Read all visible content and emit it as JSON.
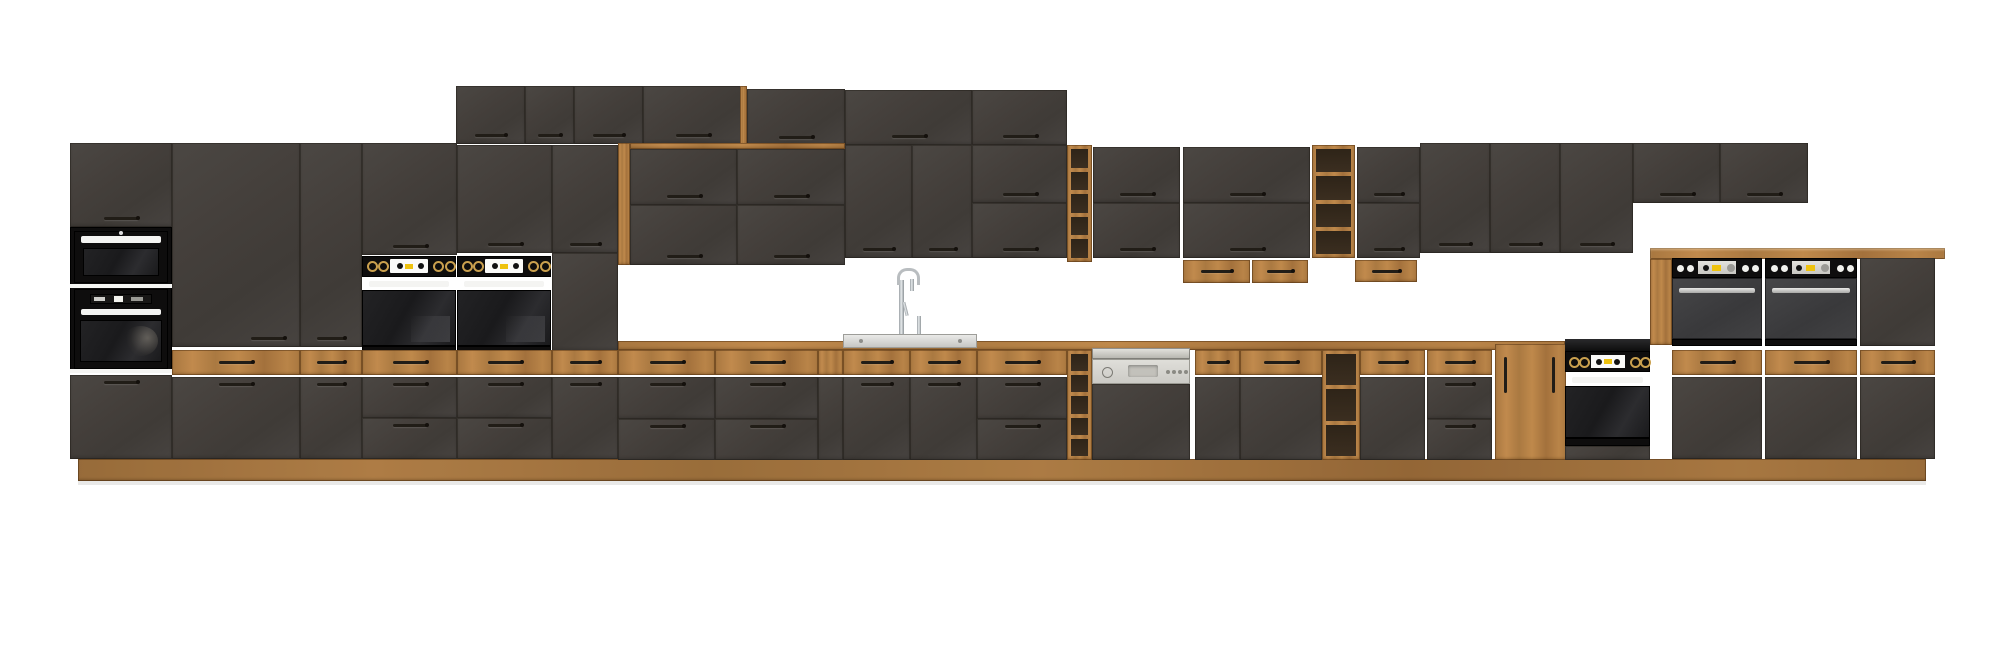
{
  "scene": {
    "description": "kitchen cabinet set product render - dark concrete-look fronts with oak wood accents and built-in appliances on white background",
    "stage": {
      "width": 2000,
      "height": 662
    },
    "colors": {
      "background": "#ffffff",
      "front_dark": "#45413d",
      "oak": "#b27e45",
      "oak_interior": "#3b2e20",
      "appliance_black": "#0e0d0d",
      "gloss_black": "#1d1d1f",
      "oven_grey": "#3f3f41",
      "steel": "#c9c9c5",
      "panel_grey": "#d8d6d0",
      "handle_dark": "#211d17",
      "handle_white": "#f4f4f2",
      "display_yellow": "#eec20e",
      "display_white": "#fafaf8",
      "knob_gold": "#caa04e",
      "chrome": "#c2c6c9",
      "white_sep": "#f5f5f3"
    },
    "modules": [
      {
        "name": "toe-kick-shadow",
        "type": "shadow",
        "x": 78,
        "y": 481,
        "w": 1848,
        "h": 4
      },
      {
        "name": "oak-plinth",
        "type": "plinth",
        "x": 78,
        "y": 459,
        "w": 1848,
        "h": 22
      },
      {
        "name": "tall-oven-tower-top-door",
        "type": "door",
        "x": 70,
        "y": 143,
        "w": 102,
        "h": 84,
        "handle": "bc"
      },
      {
        "name": "tall-oven-tower-appliance-panel",
        "type": "panelblack",
        "x": 70,
        "y": 227,
        "w": 102,
        "h": 146
      },
      {
        "name": "built-in-microwave",
        "type": "microwave",
        "x": 74,
        "y": 231,
        "w": 94,
        "h": 52
      },
      {
        "name": "microwave-oven-separator",
        "type": "whitesep",
        "x": 70,
        "y": 284,
        "w": 102,
        "h": 4
      },
      {
        "name": "built-in-oven-tower",
        "type": "toweroven",
        "x": 74,
        "y": 289,
        "w": 94,
        "h": 80
      },
      {
        "name": "oven-bottom-separator",
        "type": "whitesep",
        "x": 70,
        "y": 369,
        "w": 102,
        "h": 4
      },
      {
        "name": "tall-oven-tower-bottom-door",
        "type": "door",
        "x": 70,
        "y": 375,
        "w": 102,
        "h": 84,
        "handle": "tc"
      },
      {
        "name": "tall-pantry-door",
        "type": "door",
        "x": 172,
        "y": 143,
        "w": 128,
        "h": 204,
        "handle": "br"
      },
      {
        "name": "tall-pantry-door-narrow",
        "type": "door",
        "x": 300,
        "y": 143,
        "w": 62,
        "h": 204,
        "handle": "bc"
      },
      {
        "name": "wall-door-above-oven-1",
        "type": "door",
        "x": 362,
        "y": 143,
        "w": 95,
        "h": 112,
        "handle": "bc"
      },
      {
        "name": "wall-door-above-oven-2",
        "type": "door",
        "x": 457,
        "y": 145,
        "w": 95,
        "h": 108,
        "handle": "bc"
      },
      {
        "name": "wall-door-tall-run-end",
        "type": "door",
        "x": 552,
        "y": 145,
        "w": 66,
        "h": 108,
        "handle": "bc"
      },
      {
        "name": "tall-run-side-panel",
        "type": "paneldark",
        "x": 552,
        "y": 253,
        "w": 66,
        "h": 98
      },
      {
        "name": "built-in-oven-left-1",
        "type": "ovenblack",
        "x": 362,
        "y": 256,
        "w": 94,
        "h": 97
      },
      {
        "name": "built-in-oven-left-2",
        "type": "ovenblack",
        "x": 457,
        "y": 256,
        "w": 94,
        "h": 97
      },
      {
        "name": "top-wall-door-1",
        "type": "door",
        "x": 456,
        "y": 86,
        "w": 69,
        "h": 58,
        "handle": "bc"
      },
      {
        "name": "top-wall-door-2",
        "type": "door",
        "x": 525,
        "y": 86,
        "w": 49,
        "h": 58,
        "handle": "bc"
      },
      {
        "name": "top-wall-door-3",
        "type": "door",
        "x": 574,
        "y": 86,
        "w": 69,
        "h": 58,
        "handle": "bc"
      },
      {
        "name": "top-wall-door-4",
        "type": "door",
        "x": 643,
        "y": 86,
        "w": 99,
        "h": 58,
        "handle": "bc"
      },
      {
        "name": "top-row-oak-step-edge",
        "type": "oakstrip",
        "x": 740,
        "y": 86,
        "w": 7,
        "h": 60
      },
      {
        "name": "top-wall-door-5",
        "type": "door",
        "x": 747,
        "y": 89,
        "w": 98,
        "h": 57,
        "handle": "bc"
      },
      {
        "name": "top-wall-door-6",
        "type": "door",
        "x": 845,
        "y": 90,
        "w": 127,
        "h": 55,
        "handle": "bc"
      },
      {
        "name": "top-wall-door-7",
        "type": "door",
        "x": 972,
        "y": 90,
        "w": 95,
        "h": 55,
        "handle": "bc"
      },
      {
        "name": "recess-oak-lining-left",
        "type": "oakstrip",
        "x": 618,
        "y": 143,
        "w": 12,
        "h": 122
      },
      {
        "name": "recess-oak-lining-top",
        "type": "oakstrip",
        "x": 630,
        "y": 143,
        "w": 215,
        "h": 6
      },
      {
        "name": "recess-wall-door-1",
        "type": "door",
        "x": 630,
        "y": 149,
        "w": 107,
        "h": 56,
        "handle": "bc"
      },
      {
        "name": "recess-wall-door-2",
        "type": "door",
        "x": 737,
        "y": 149,
        "w": 108,
        "h": 56,
        "handle": "bc"
      },
      {
        "name": "recess-wall-door-3",
        "type": "door",
        "x": 630,
        "y": 205,
        "w": 107,
        "h": 60,
        "handle": "bc"
      },
      {
        "name": "recess-wall-door-4",
        "type": "door",
        "x": 737,
        "y": 205,
        "w": 108,
        "h": 60,
        "handle": "bc"
      },
      {
        "name": "wall-door-8",
        "type": "door",
        "x": 845,
        "y": 145,
        "w": 67,
        "h": 113,
        "handle": "bc"
      },
      {
        "name": "wall-door-9",
        "type": "door",
        "x": 912,
        "y": 145,
        "w": 60,
        "h": 113,
        "handle": "bc"
      },
      {
        "name": "wall-door-10",
        "type": "door",
        "x": 972,
        "y": 145,
        "w": 95,
        "h": 58,
        "handle": "bc"
      },
      {
        "name": "wall-door-11",
        "type": "door",
        "x": 972,
        "y": 203,
        "w": 95,
        "h": 55,
        "handle": "bc"
      },
      {
        "name": "wall-open-shelf-1",
        "type": "shelf",
        "x": 1067,
        "y": 145,
        "w": 25,
        "h": 117,
        "comps": 5
      },
      {
        "name": "wall-door-12",
        "type": "door",
        "x": 1093,
        "y": 147,
        "w": 87,
        "h": 56,
        "handle": "bc"
      },
      {
        "name": "wall-door-13",
        "type": "door",
        "x": 1093,
        "y": 203,
        "w": 87,
        "h": 55,
        "handle": "bc"
      },
      {
        "name": "wall-door-14",
        "type": "door",
        "x": 1183,
        "y": 147,
        "w": 127,
        "h": 56,
        "handle": "bc"
      },
      {
        "name": "wall-door-15",
        "type": "door",
        "x": 1183,
        "y": 203,
        "w": 127,
        "h": 55,
        "handle": "bc"
      },
      {
        "name": "hanging-oak-box-1",
        "type": "oakbox",
        "x": 1183,
        "y": 260,
        "w": 67,
        "h": 23
      },
      {
        "name": "hanging-oak-box-2",
        "type": "oakbox",
        "x": 1252,
        "y": 260,
        "w": 56,
        "h": 23
      },
      {
        "name": "wall-open-shelf-2",
        "type": "shelf",
        "x": 1312,
        "y": 145,
        "w": 43,
        "h": 113,
        "comps": 4
      },
      {
        "name": "wall-door-16",
        "type": "door",
        "x": 1357,
        "y": 147,
        "w": 63,
        "h": 56,
        "handle": "bc"
      },
      {
        "name": "wall-door-17",
        "type": "door",
        "x": 1357,
        "y": 203,
        "w": 63,
        "h": 55,
        "handle": "bc"
      },
      {
        "name": "hanging-oak-box-3",
        "type": "oakbox",
        "x": 1355,
        "y": 260,
        "w": 62,
        "h": 22
      },
      {
        "name": "wall-door-18",
        "type": "door",
        "x": 1420,
        "y": 143,
        "w": 70,
        "h": 110,
        "handle": "bc"
      },
      {
        "name": "wall-door-19",
        "type": "door",
        "x": 1490,
        "y": 143,
        "w": 70,
        "h": 110,
        "handle": "bc"
      },
      {
        "name": "wall-door-20",
        "type": "door",
        "x": 1560,
        "y": 143,
        "w": 73,
        "h": 110,
        "handle": "bc"
      },
      {
        "name": "wall-door-21",
        "type": "door",
        "x": 1633,
        "y": 143,
        "w": 87,
        "h": 60,
        "handle": "bc"
      },
      {
        "name": "wall-door-22",
        "type": "door",
        "x": 1720,
        "y": 143,
        "w": 88,
        "h": 60,
        "handle": "bc"
      },
      {
        "name": "counter-oak-edge",
        "type": "oakstrip",
        "x": 618,
        "y": 341,
        "w": 947,
        "h": 9
      },
      {
        "name": "oak-drawer-l1",
        "type": "oakdrawer",
        "x": 172,
        "y": 350,
        "w": 128,
        "h": 25
      },
      {
        "name": "oak-drawer-l2",
        "type": "oakdrawer",
        "x": 300,
        "y": 350,
        "w": 62,
        "h": 25
      },
      {
        "name": "oak-drawer-l3",
        "type": "oakdrawer",
        "x": 362,
        "y": 350,
        "w": 95,
        "h": 25
      },
      {
        "name": "oak-drawer-l4",
        "type": "oakdrawer",
        "x": 457,
        "y": 350,
        "w": 95,
        "h": 25
      },
      {
        "name": "oak-drawer-l5",
        "type": "oakdrawer",
        "x": 552,
        "y": 350,
        "w": 66,
        "h": 25
      },
      {
        "name": "oak-drawer-m1",
        "type": "oakdrawer",
        "x": 618,
        "y": 350,
        "w": 97,
        "h": 25
      },
      {
        "name": "oak-drawer-m2",
        "type": "oakdrawer",
        "x": 715,
        "y": 350,
        "w": 103,
        "h": 25
      },
      {
        "name": "oak-filler",
        "type": "oakdrawer",
        "x": 818,
        "y": 350,
        "w": 25,
        "h": 25,
        "nohandle": true
      },
      {
        "name": "oak-drawer-sink-1",
        "type": "oakdrawer",
        "x": 843,
        "y": 350,
        "w": 67,
        "h": 25
      },
      {
        "name": "oak-drawer-sink-2",
        "type": "oakdrawer",
        "x": 910,
        "y": 350,
        "w": 67,
        "h": 25
      },
      {
        "name": "oak-drawer-m3",
        "type": "oakdrawer",
        "x": 977,
        "y": 350,
        "w": 90,
        "h": 25
      },
      {
        "name": "base-open-shelf-1",
        "type": "shelf",
        "x": 1067,
        "y": 350,
        "w": 25,
        "h": 110,
        "comps": 5
      },
      {
        "name": "semi-integrated-dishwasher",
        "type": "dishwasher",
        "x": 1092,
        "y": 348,
        "w": 98,
        "h": 112
      },
      {
        "name": "oak-drawer-m4",
        "type": "oakdrawer",
        "x": 1195,
        "y": 350,
        "w": 45,
        "h": 25
      },
      {
        "name": "oak-drawer-m5",
        "type": "oakdrawer",
        "x": 1240,
        "y": 350,
        "w": 82,
        "h": 25
      },
      {
        "name": "base-open-shelf-2",
        "type": "shelf",
        "x": 1322,
        "y": 350,
        "w": 38,
        "h": 110,
        "comps": 3
      },
      {
        "name": "oak-drawer-m6",
        "type": "oakdrawer",
        "x": 1360,
        "y": 350,
        "w": 65,
        "h": 25
      },
      {
        "name": "oak-drawer-m7",
        "type": "oakdrawer",
        "x": 1427,
        "y": 350,
        "w": 65,
        "h": 25
      },
      {
        "name": "base-door-l1",
        "type": "door",
        "x": 172,
        "y": 377,
        "w": 128,
        "h": 82,
        "handle": "tc"
      },
      {
        "name": "base-door-l2",
        "type": "door",
        "x": 300,
        "y": 377,
        "w": 62,
        "h": 82,
        "handle": "tc"
      },
      {
        "name": "base-drawers-l1",
        "type": "drawers2",
        "x": 362,
        "y": 377,
        "w": 95,
        "h": 82
      },
      {
        "name": "base-drawers-l2",
        "type": "drawers2",
        "x": 457,
        "y": 377,
        "w": 95,
        "h": 82
      },
      {
        "name": "base-door-l3",
        "type": "door",
        "x": 552,
        "y": 377,
        "w": 66,
        "h": 82,
        "handle": "tc"
      },
      {
        "name": "base-drawers-m1",
        "type": "drawers2",
        "x": 618,
        "y": 377,
        "w": 97,
        "h": 83
      },
      {
        "name": "base-drawers-m2",
        "type": "drawers2",
        "x": 715,
        "y": 377,
        "w": 103,
        "h": 83
      },
      {
        "name": "base-filler-dark",
        "type": "paneldark",
        "x": 818,
        "y": 377,
        "w": 25,
        "h": 83
      },
      {
        "name": "sink-base-door-1",
        "type": "door",
        "x": 843,
        "y": 377,
        "w": 67,
        "h": 83,
        "handle": "tc"
      },
      {
        "name": "sink-base-door-2",
        "type": "door",
        "x": 910,
        "y": 377,
        "w": 67,
        "h": 83,
        "handle": "tc"
      },
      {
        "name": "base-drawers-m3",
        "type": "drawers2",
        "x": 977,
        "y": 377,
        "w": 90,
        "h": 83
      },
      {
        "name": "base-door-m4",
        "type": "door",
        "x": 1195,
        "y": 377,
        "w": 45,
        "h": 83
      },
      {
        "name": "base-door-m5",
        "type": "door",
        "x": 1240,
        "y": 377,
        "w": 82,
        "h": 83
      },
      {
        "name": "base-door-m6",
        "type": "door",
        "x": 1360,
        "y": 377,
        "w": 65,
        "h": 83
      },
      {
        "name": "base-drawers-m7",
        "type": "drawers2",
        "x": 1427,
        "y": 377,
        "w": 65,
        "h": 83
      },
      {
        "name": "oak-base-cabinet",
        "type": "oakcab",
        "x": 1495,
        "y": 344,
        "w": 71,
        "h": 116
      },
      {
        "name": "kitchen-sink",
        "type": "sink",
        "x": 843,
        "y": 334,
        "w": 134,
        "h": 14
      },
      {
        "name": "black-cooktop-strip",
        "type": "cooktop",
        "x": 1565,
        "y": 339,
        "w": 85,
        "h": 12
      },
      {
        "name": "built-in-single-oven",
        "type": "ovensingle",
        "x": 1565,
        "y": 351,
        "w": 85,
        "h": 109
      },
      {
        "name": "right-bank-oak-countertop",
        "type": "counter",
        "x": 1650,
        "y": 248,
        "w": 295,
        "h": 11
      },
      {
        "name": "right-bank-oak-side-panel",
        "type": "oakstrip",
        "x": 1650,
        "y": 259,
        "w": 22,
        "h": 86
      },
      {
        "name": "built-in-wall-oven-right-1",
        "type": "ovengrey",
        "x": 1672,
        "y": 258,
        "w": 90,
        "h": 88
      },
      {
        "name": "built-in-wall-oven-right-2",
        "type": "ovengrey",
        "x": 1765,
        "y": 258,
        "w": 92,
        "h": 88
      },
      {
        "name": "right-bank-top-door",
        "type": "paneldark",
        "x": 1860,
        "y": 258,
        "w": 75,
        "h": 88
      },
      {
        "name": "oak-drawer-r1",
        "type": "oakdrawer",
        "x": 1672,
        "y": 350,
        "w": 90,
        "h": 25
      },
      {
        "name": "oak-drawer-r2",
        "type": "oakdrawer",
        "x": 1765,
        "y": 350,
        "w": 92,
        "h": 25
      },
      {
        "name": "oak-drawer-r3",
        "type": "oakdrawer",
        "x": 1860,
        "y": 350,
        "w": 75,
        "h": 25
      },
      {
        "name": "base-door-r1",
        "type": "door",
        "x": 1672,
        "y": 377,
        "w": 90,
        "h": 82
      },
      {
        "name": "base-door-r2",
        "type": "door",
        "x": 1765,
        "y": 377,
        "w": 92,
        "h": 82
      },
      {
        "name": "base-door-r3",
        "type": "door",
        "x": 1860,
        "y": 377,
        "w": 75,
        "h": 82
      }
    ]
  }
}
